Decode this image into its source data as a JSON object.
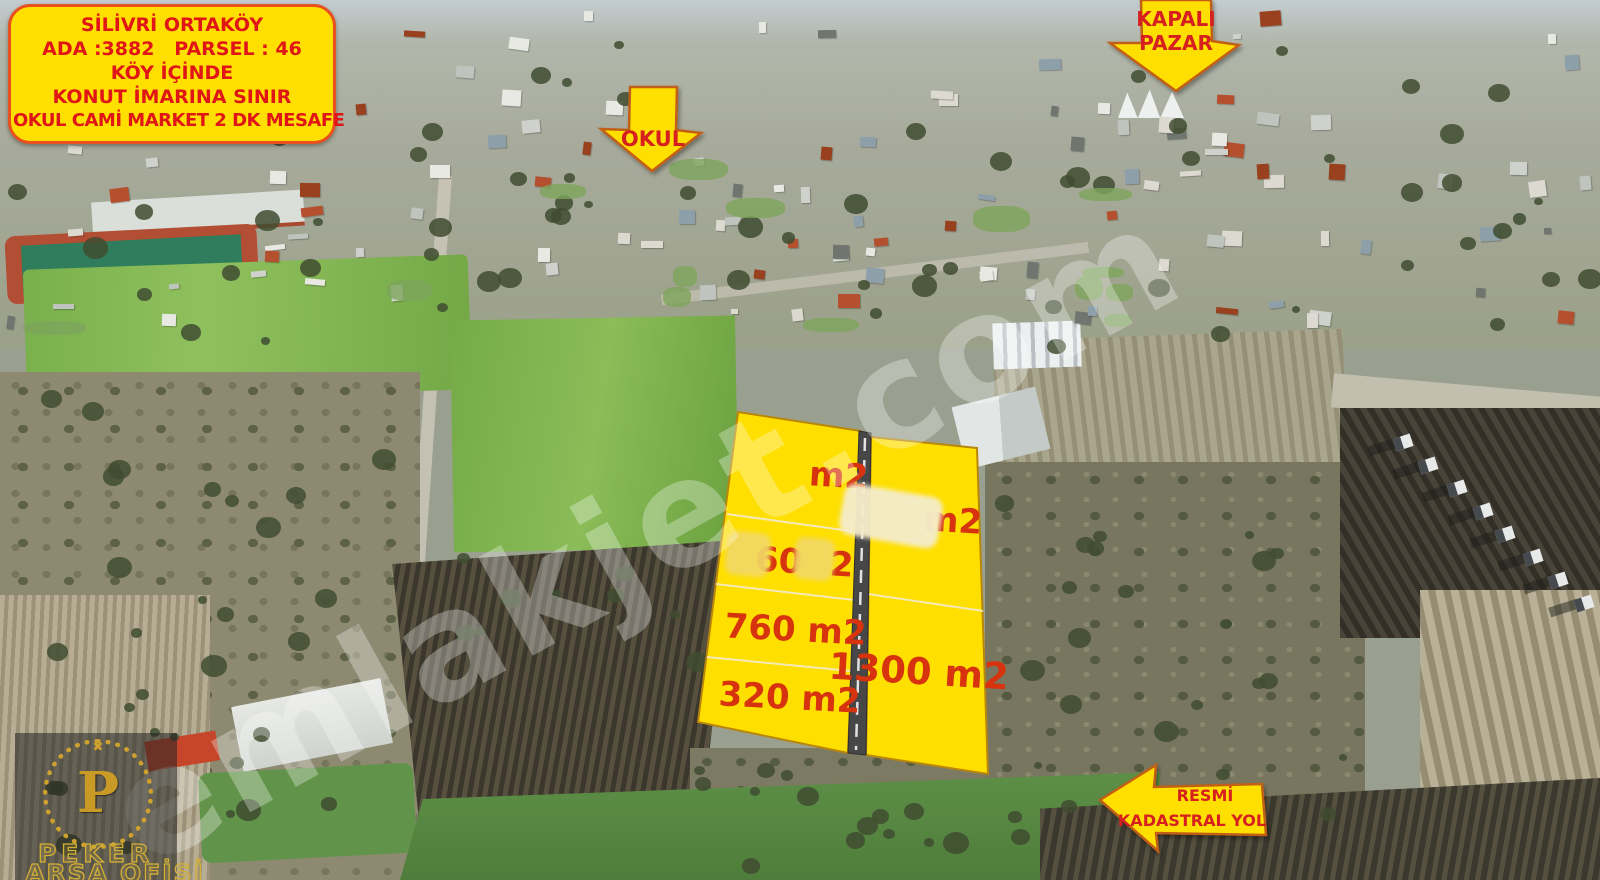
{
  "watermark": "emlakjet.com",
  "info_sign": {
    "lines": [
      "SİLİVRİ ORTAKÖY",
      "ADA :3882   PARSEL : 46",
      "KÖY İÇİNDE",
      "KONUT İMARINA SINIR",
      "OKUL CAMİ MARKET 2 DK MESAFE"
    ]
  },
  "arrows": {
    "okul_label": "OKUL",
    "kapali_pazar": {
      "line1": "KAPALI",
      "line2": "PAZAR"
    },
    "kadastral": {
      "line1": "RESMİ",
      "line2": "KADASTRAL YOL"
    }
  },
  "parcel_plots": {
    "left": [
      {
        "label": "m2"
      },
      {
        "fragment_a": "60",
        "fragment_b": "2"
      },
      {
        "label": "760 m2"
      },
      {
        "label": "320 m2"
      }
    ],
    "right": [
      {
        "label": "m2"
      },
      {
        "label": "1300 m2"
      }
    ]
  },
  "brand": {
    "monogram": "P",
    "line1": "PEKER",
    "line2": "ARSA OFİSİ"
  },
  "colors": {
    "overlay_yellow": "#ffdf00",
    "label_red": "#d6330e",
    "sign_text_red": "#e01515",
    "road_gray": "#474747"
  }
}
